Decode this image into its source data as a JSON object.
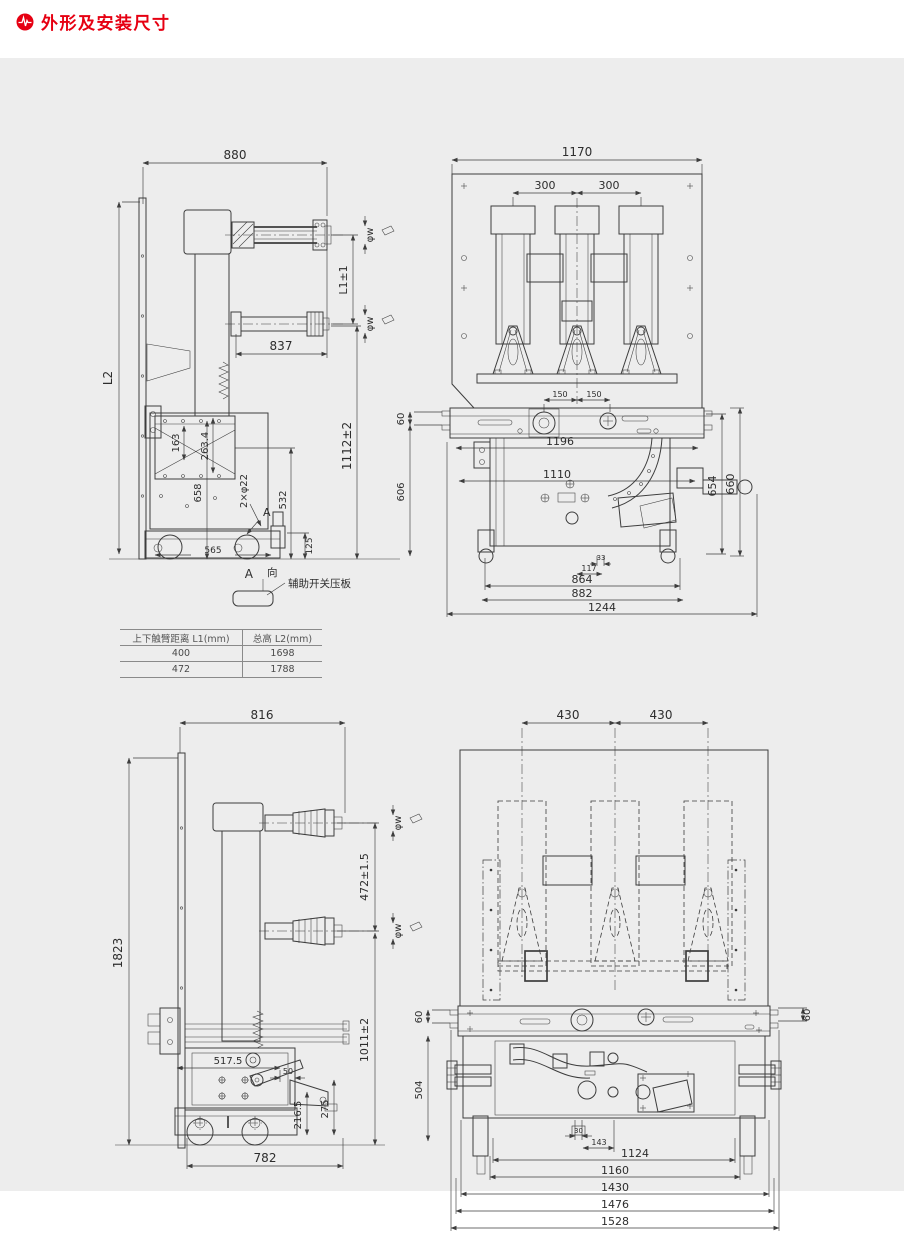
{
  "header": {
    "title": "外形及安装尺寸"
  },
  "spec_table": {
    "col1_header": "上下触臂距离 L1(mm)",
    "col2_header": "总高 L2(mm)",
    "rows": [
      {
        "l1": "400",
        "l2": "1698"
      },
      {
        "l1": "472",
        "l2": "1788"
      }
    ]
  },
  "top_side_view": {
    "width": "880",
    "height_label": "L2",
    "arm_length": "837",
    "arm_gap": "L1±1",
    "phi_upper": "φw",
    "phi_lower": "φw",
    "d163": "163",
    "d263": "263.4",
    "d658": "658",
    "holes": "2×φ22",
    "d532": "532",
    "d125": "125",
    "d565": "565",
    "h1112": "1112±2",
    "view_a_inner": "A",
    "view_a": "A",
    "view_dir": "向",
    "aux_label": "辅助开关压板"
  },
  "top_front_view": {
    "width": "1170",
    "pole_left": "300",
    "pole_right": "300",
    "c150l": "150",
    "c150r": "150",
    "d60": "60",
    "d606": "606",
    "d1196": "1196",
    "d1110": "1110",
    "d654": "654",
    "d660": "660",
    "d33": "33",
    "d117": "117",
    "d864": "864",
    "d882": "882",
    "d1244": "1244"
  },
  "bottom_side_view": {
    "width": "816",
    "height": "1823",
    "arm_gap": "472±1.5",
    "phi_upper": "φw",
    "phi_lower": "φw",
    "h1011": "1011±2",
    "d5175": "517.5",
    "d50": "50",
    "d2165": "216.5",
    "d275": "275",
    "w782": "782"
  },
  "bottom_front_view": {
    "pole_left": "430",
    "pole_right": "430",
    "d60l": "60",
    "d60r": "60",
    "d504": "504",
    "d30": "30",
    "d143": "143",
    "d1124": "1124",
    "d1160": "1160",
    "d1430": "1430",
    "d1476": "1476",
    "d1528": "1528"
  }
}
